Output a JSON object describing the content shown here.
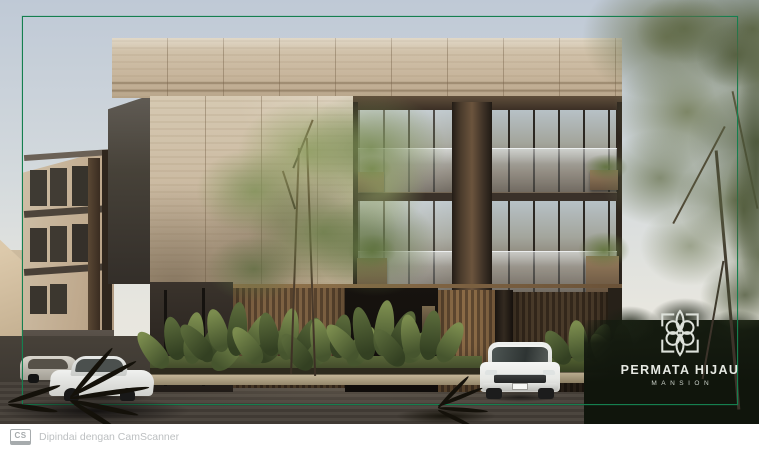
{
  "branding": {
    "title": "PERMATA HIJAU",
    "subtitle": "MANSION",
    "icon": "lotus-flower-icon",
    "text_color": "#e6e9e3"
  },
  "watermark": {
    "badge": "CS",
    "text": "Dipindai dengan CamScanner",
    "icon": "camscanner-badge",
    "text_color": "#bdc0c2"
  },
  "frame": {
    "color": "#157f4f"
  },
  "palette": {
    "sky_top": "#bfc9d6",
    "sky_bottom": "#ece9e0",
    "travertine": "#c8b69d",
    "bronze_wood": "#4a3b2c",
    "glass": "#a3a59c",
    "foliage_green": "#6e7c4c",
    "dark_foliage": "#141a0f",
    "driveway": "#48423c",
    "car_white": "#f0f1ef"
  }
}
